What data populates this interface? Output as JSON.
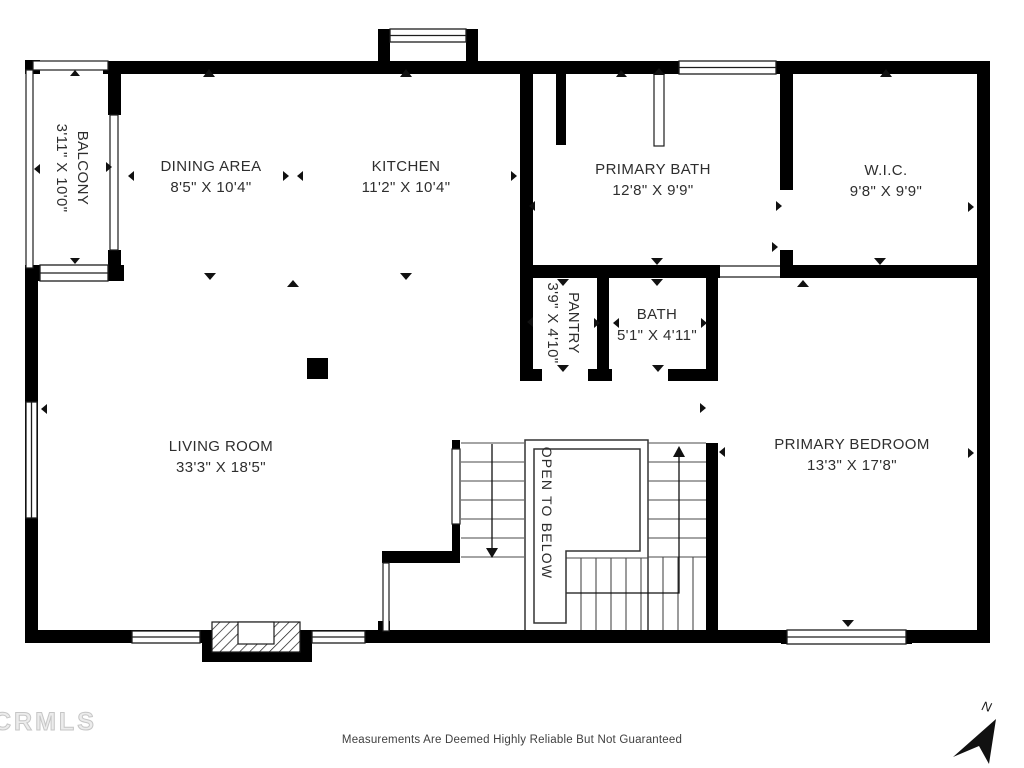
{
  "plan": {
    "rooms": [
      {
        "id": "balcony",
        "name": "BALCONY",
        "dims": "3'11\" X 10'0\""
      },
      {
        "id": "dining-area",
        "name": "DINING AREA",
        "dims": "8'5\" X 10'4\""
      },
      {
        "id": "kitchen",
        "name": "KITCHEN",
        "dims": "11'2\" X 10'4\""
      },
      {
        "id": "primary-bath",
        "name": "PRIMARY BATH",
        "dims": "12'8\" X 9'9\""
      },
      {
        "id": "wic",
        "name": "W.I.C.",
        "dims": "9'8\" X 9'9\""
      },
      {
        "id": "pantry",
        "name": "PANTRY",
        "dims": "3'9\" X 4'10\""
      },
      {
        "id": "bath",
        "name": "BATH",
        "dims": "5'1\" X 4'11\""
      },
      {
        "id": "living-room",
        "name": "LIVING ROOM",
        "dims": "33'3\" X 18'5\""
      },
      {
        "id": "primary-bedroom",
        "name": "PRIMARY BEDROOM",
        "dims": "13'3\" X 17'8\""
      }
    ],
    "stairwell": {
      "label": "OPEN TO BELOW"
    },
    "compass": {
      "label": "N",
      "icon": "northeast-arrow-icon"
    },
    "footer": {
      "watermark": "CRMLS",
      "disclaimer": "Measurements Are Deemed Highly Reliable But Not Guaranteed"
    },
    "colors": {
      "wall": "#000000",
      "line": "#333333",
      "text": "#2e2e2e",
      "watermark": "#d6d6d6"
    }
  }
}
